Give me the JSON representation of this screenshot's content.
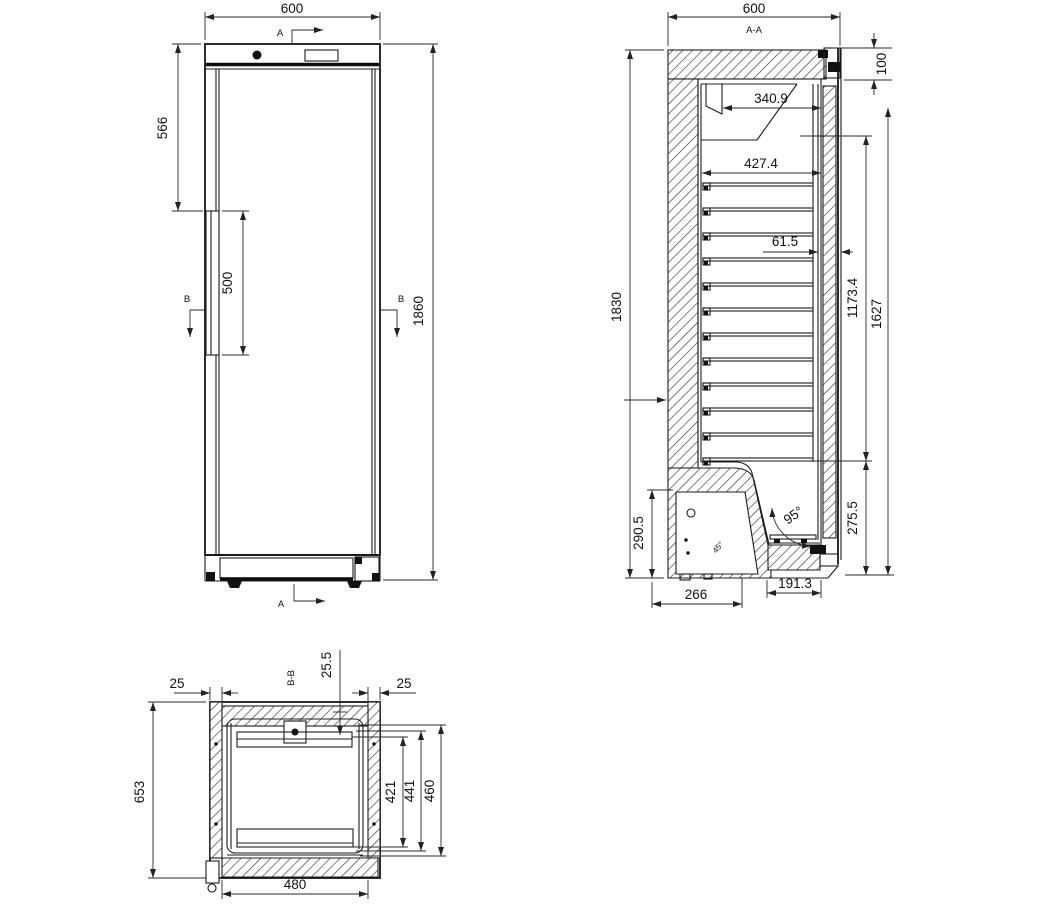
{
  "drawing": {
    "front": {
      "cut_a": "A",
      "cut_b": "B",
      "width": "600",
      "height": "1860",
      "handle_offset_top": "566",
      "handle_length": "500"
    },
    "side": {
      "label": "A-A",
      "width": "600",
      "height": "1830",
      "top_clearance": "100",
      "evap_depth": "340.9",
      "shelf_depth": "427.4",
      "door_thickness": "61.5",
      "interior_height": "1173.4",
      "door_height": "1627",
      "recess_height": "275.5",
      "compressor_height": "290.5",
      "base_depth": "266",
      "recess_depth": "191.3",
      "door_angle": "95°",
      "slant_angle": "45°"
    },
    "bottom": {
      "label": "B-B",
      "depth": "653",
      "interior_width": "480",
      "left_wall": "25",
      "right_wall": "25",
      "back_gap": "25.5",
      "inner_depth_1": "421",
      "inner_depth_2": "441",
      "inner_depth_3": "460"
    }
  }
}
